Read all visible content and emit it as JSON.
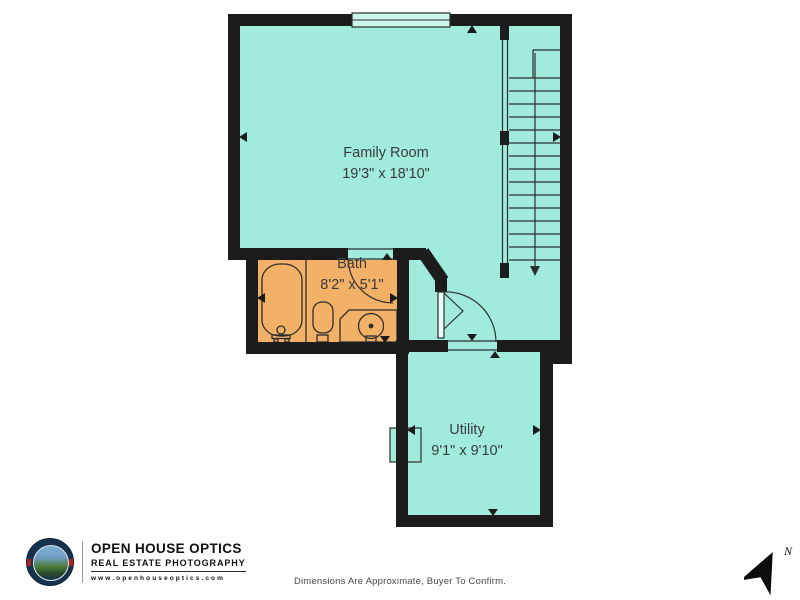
{
  "branding": {
    "name": "OPEN HOUSE OPTICS",
    "tagline": "REAL ESTATE PHOTOGRAPHY",
    "website": "www.openhouseoptics.com"
  },
  "rooms": [
    {
      "name": "Family Room",
      "dims": "19'3\" x 18'10\""
    },
    {
      "name": "Bath",
      "dims": "8'2\" x 5'1\""
    },
    {
      "name": "Utility",
      "dims": "9'1\" x 9'10\""
    }
  ],
  "footer": {
    "disclaimer": "Dimensions Are Approximate, Buyer To Confirm."
  },
  "compass": {
    "north_label": "N"
  },
  "colors": {
    "room_fill": "#a1ebdc",
    "bath_fill": "#f2b166",
    "wall": "#1c1c1c",
    "fixture_line": "#2d2d2d",
    "window_glass": "#ccf5ec"
  }
}
